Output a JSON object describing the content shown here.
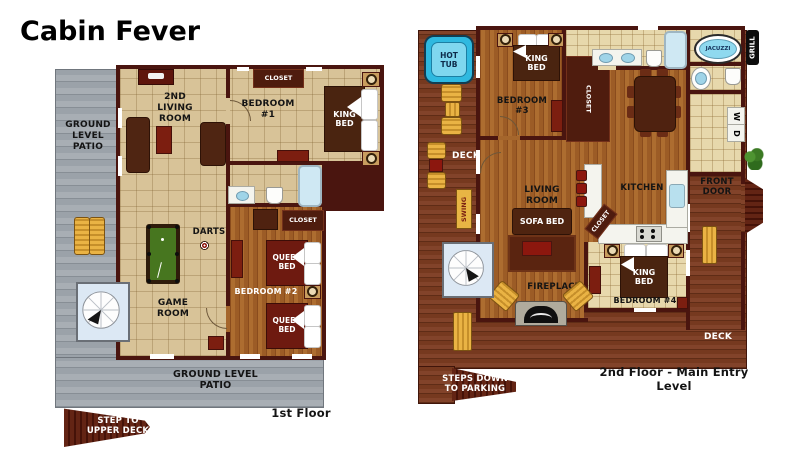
{
  "title": "Cabin Fever",
  "palette": {
    "wall": "#4a150f",
    "floor_tile": "#d8c398",
    "wood": "#a5662c",
    "deck": "#7b3c21",
    "patio_gray": "#a0a7ae",
    "bath_tile": "#e7d8ac",
    "hot_tub_blue": "#35bfe4",
    "accent_red": "#8c170e",
    "furniture_tan": "#e0a93e",
    "pool_felt": "#47761f"
  },
  "floor1": {
    "patio_left": "GROUND\nLEVEL\nPATIO",
    "living2": "2ND\nLIVING\nROOM",
    "closet_bed1": "CLOSET",
    "bedroom1": "BEDROOM\n#1",
    "king_bed": "KING\nBED",
    "darts": "DARTS",
    "game_room": "GAME\nROOM",
    "closet_bed2": "CLOSET",
    "queen_bed_top": "QUEEN\nBED",
    "queen_bed_bottom": "QUEEN\nBED",
    "bedroom2": "BEDROOM #2",
    "patio_bottom": "GROUND LEVEL\nPATIO",
    "step_upper": "STEP TO\nUPPER DECK",
    "caption": "1st Floor"
  },
  "floor2": {
    "hot_tub": "HOT\nTUB",
    "king_bed3": "KING\nBED",
    "bedroom3": "BEDROOM\n#3",
    "closet_bed3": "CLOSET",
    "jacuzzi": "JACUZZI",
    "grill": "GRILL",
    "washer": "W",
    "dryer": "D",
    "deck_left": "DECK",
    "swing": "SWING",
    "living": "LIVING\nROOM",
    "sofa_bed": "SOFA BED",
    "kitchen": "KITCHEN",
    "closet_kitchen": "CLOSET",
    "fireplace": "FIREPLACE",
    "king_bed4": "KING\nBED",
    "bedroom4": "BEDROOM #4",
    "front_door": "FRONT\nDOOR",
    "deck_bottom": "DECK",
    "steps_parking": "STEPS DOWN\nTO PARKING",
    "caption": "2nd Floor - Main Entry Level"
  }
}
